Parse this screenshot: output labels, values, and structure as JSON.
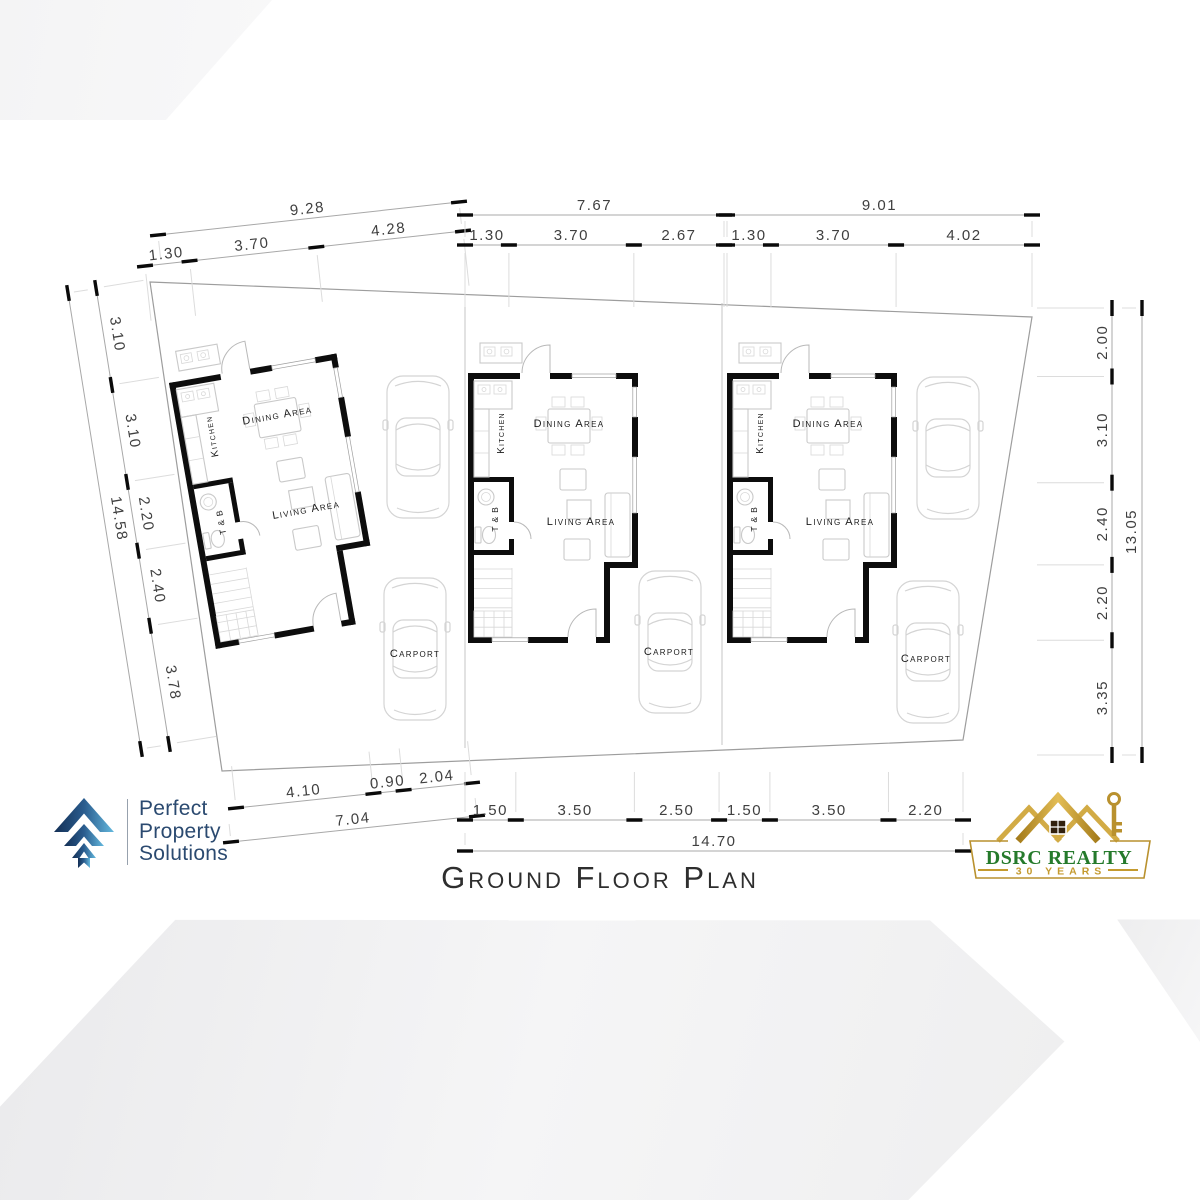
{
  "title": {
    "text": "Ground Floor Plan"
  },
  "site": {
    "lots": [
      {
        "carport": "Carport",
        "rooms": {
          "kitchen": "Kitchen",
          "dining": "Dining Area",
          "living": "Living Area",
          "toilet": "T & B"
        }
      },
      {
        "carport": "Carport",
        "rooms": {
          "kitchen": "Kitchen",
          "dining": "Dining Area",
          "living": "Living Area",
          "toilet": "T & B"
        }
      },
      {
        "carport": "Carport",
        "rooms": {
          "kitchen": "Kitchen",
          "dining": "Dining Area",
          "living": "Living Area",
          "toilet": "T & B"
        }
      }
    ]
  },
  "dimensions": {
    "top": [
      {
        "overall": "9.28",
        "segments": [
          "1.30",
          "3.70",
          "4.28"
        ]
      },
      {
        "overall": "7.67",
        "segments": [
          "1.30",
          "3.70",
          "2.67"
        ]
      },
      {
        "overall": "9.01",
        "segments": [
          "1.30",
          "3.70",
          "4.02"
        ]
      }
    ],
    "left": {
      "overall": "14.58",
      "segments": [
        "3.10",
        "3.10",
        "2.20",
        "2.40",
        "3.78"
      ]
    },
    "right": {
      "overall": "13.05",
      "segments": [
        "2.00",
        "3.10",
        "2.40",
        "2.20",
        "3.35"
      ]
    },
    "bottom_left": {
      "overall": "7.04",
      "segments": [
        "4.10",
        "0.90",
        "2.04"
      ]
    },
    "bottom": {
      "overall": "14.70",
      "segments": [
        "1.50",
        "3.50",
        "2.50",
        "1.50",
        "3.50",
        "2.20"
      ]
    }
  },
  "logos": {
    "pps": {
      "lines": [
        "Perfect",
        "Property",
        "Solutions"
      ],
      "text_color": "#2b4a70",
      "icon_colors": [
        "#132f55",
        "#2a5c8e",
        "#64b9de"
      ]
    },
    "dsrc": {
      "name": "DSRC REALTY",
      "tagline": "30 YEARS",
      "name_color": "#257a2b",
      "gold_color": "#c49a2e"
    }
  }
}
